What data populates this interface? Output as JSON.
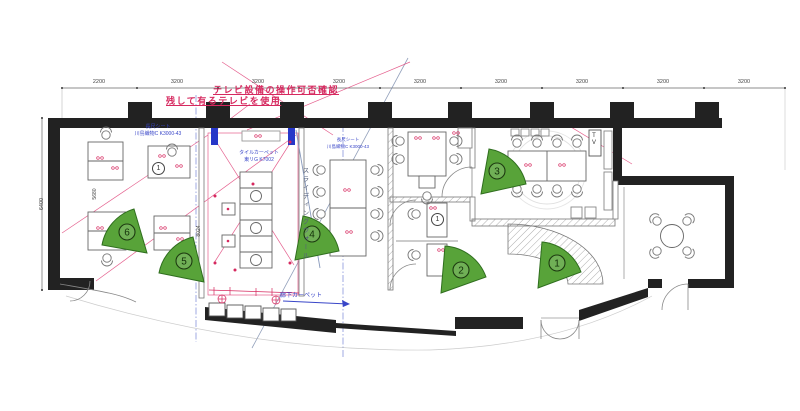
{
  "plan": {
    "red_note": {
      "line1": "テレビ設備の操作可否確認",
      "line2": "残して有るテレビを使用"
    },
    "rooms": {
      "left_room": {
        "finish_line1": "長尺シート",
        "finish_line2": "川島織物C K3000-43"
      },
      "tile_area": {
        "finish_line1": "タイルカーペット",
        "finish_line2": "東リG K7002"
      },
      "meeting_room": {
        "finish_line1": "長尺シート",
        "finish_line2": "川島織物C K3000-43"
      },
      "corridor": {
        "carpet_label": "廊下カーペット"
      },
      "sliding_wall_label": "スライディングウォール",
      "tv_label": "TV"
    },
    "dimensions": {
      "top": [
        "2200",
        "3200",
        "3200",
        "3200",
        "3200",
        "3200",
        "3200",
        "3200",
        "3200"
      ],
      "left_overall": "6400",
      "left_interior": "5680",
      "center_interior": "8024"
    },
    "markers": [
      {
        "number": "1"
      },
      {
        "number": "2"
      },
      {
        "number": "3"
      },
      {
        "number": "4"
      },
      {
        "number": "5"
      },
      {
        "number": "6"
      }
    ],
    "furniture_notes": {
      "seat_annotation": "1"
    },
    "colors": {
      "marker_green": "#58a339",
      "marker_green_dark": "#2f6e1e",
      "annotation_red": "#d6295f",
      "annotation_blue": "#3946c8",
      "wall_black": "#222222"
    }
  }
}
